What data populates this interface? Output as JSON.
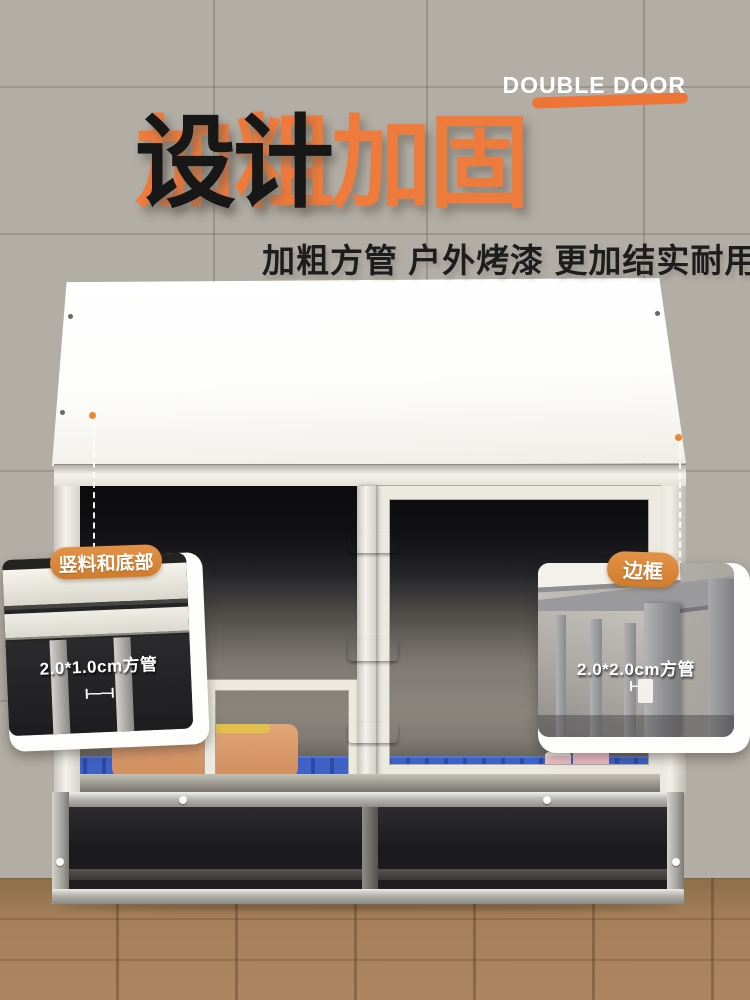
{
  "badge": {
    "text": "DOUBLE DOOR"
  },
  "title": {
    "highlight": "加粗加固",
    "normal": "设计"
  },
  "subtitle": "加粗方管 户外烤漆 更加结实耐用",
  "callout_left": {
    "label": "竖料和底部",
    "spec": "2.0*1.0cm方管"
  },
  "callout_right": {
    "label": "边框",
    "spec": "2.0*2.0cm方管"
  },
  "colors": {
    "accent_orange": "#ee7a3b",
    "badge_underline": "#ed7434",
    "pill_orange": "#d98a3c",
    "title_black": "#171717",
    "wall_gray": "#b2ada5",
    "blue_floor": "#3e62c6",
    "wood_floor": "#a5805a"
  }
}
